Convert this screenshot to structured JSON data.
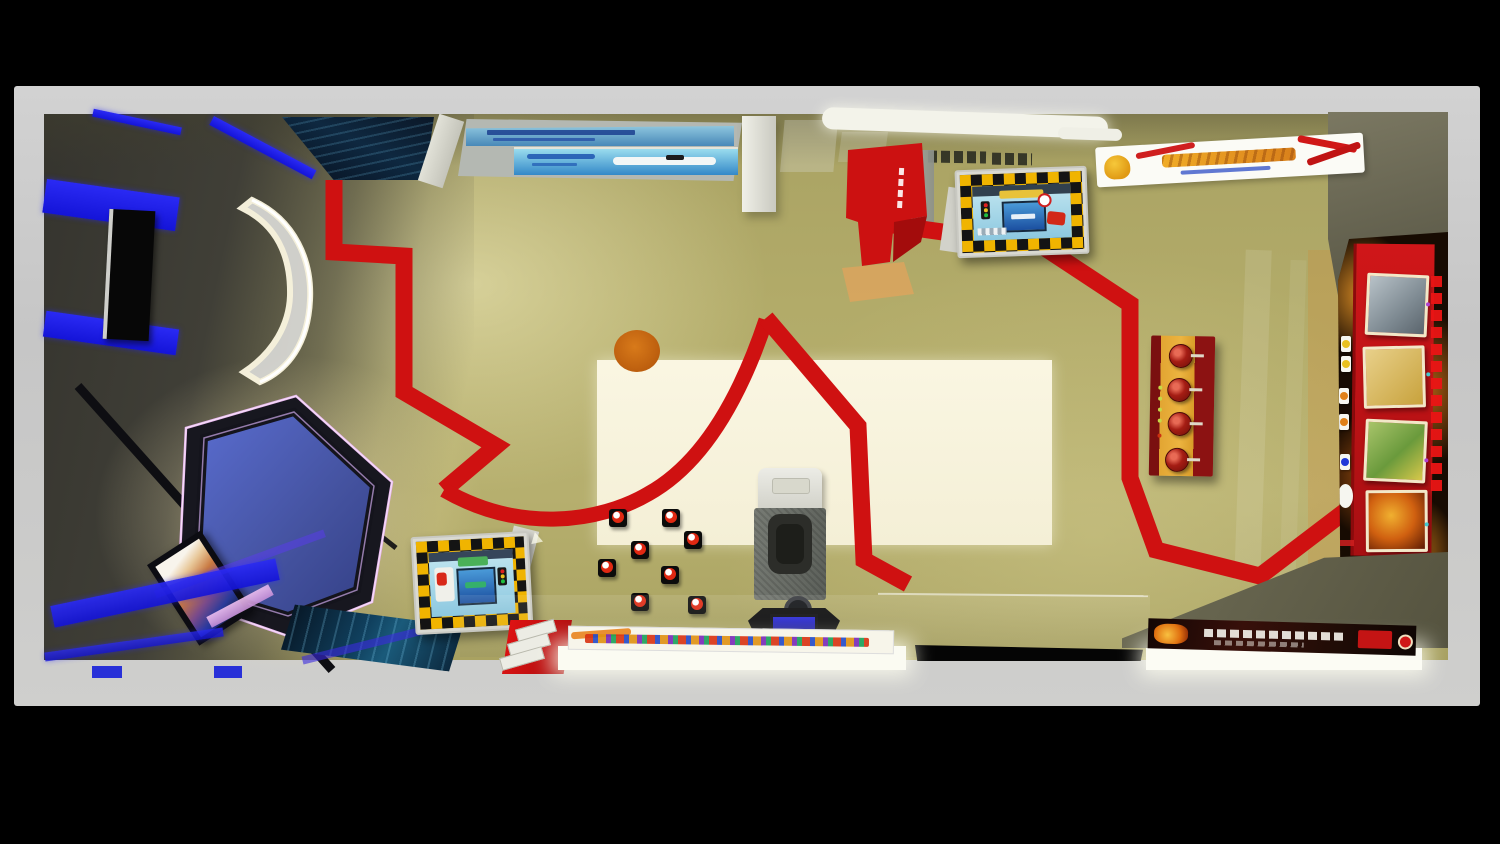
{
  "image": {
    "kind": "3D rendered top-down view",
    "subject": "Public safety education exhibition hall (traffic and fire safety experience room)",
    "background": "#000000",
    "legible_text": false
  },
  "palette": {
    "outer_frame": "#c9c9c9",
    "floor": "#b2ab69",
    "floor_inlay": "#f8f4de",
    "guide_path_red": "#cf1111",
    "led_blue": "#1f1ff0",
    "neon_pink": "#e9b7f0",
    "hexagon_blue": "#4c5fc4",
    "checker_yellow": "#f0b400",
    "flame_orange": "#d0761c",
    "panel_red": "#c01317",
    "console_gold": "#e0a32e",
    "screen_blue": "#3a7fb8",
    "lightbox_white": "#fbfbf2",
    "marker_orange": "#cc6d14"
  },
  "exhibits": {
    "entry_screen_wall": {
      "label": "wall-mounted blue info screens with ship image",
      "note": "captions illegible"
    },
    "starfield_panel": {
      "label": "dark starfield graphic wall panel"
    },
    "reception_desk": {
      "label": "white curved glowing reception desk"
    },
    "vr_hexagon": {
      "label": "hexagonal VR platform with pink neon edge and blue deck"
    },
    "truss_beams": {
      "label": "black diagonal truss beams"
    },
    "media_screen": {
      "label": "tilted media screen with colorful content"
    },
    "ocean_graphic": {
      "label": "dark ocean floor graphic"
    },
    "led_strips": {
      "label": "blue LED floor strips in dark west zone"
    },
    "traffic_game_table_north": {
      "label": "traffic-safety game table, yellow-black checker border"
    },
    "traffic_game_table_south": {
      "label": "traffic-safety game table, yellow-black checker border"
    },
    "red_guide_path": {
      "label": "red visitor guide path painted on floor"
    },
    "orange_floor_dot": {
      "label": "orange circular floor marker"
    },
    "stools": {
      "label": "eight square stools with red target cushions",
      "count": 8
    },
    "riding_simulator": {
      "label": "riding simulator with seat and floor screen"
    },
    "extinguisher_console": {
      "label": "gold console holding four red fire extinguishers"
    },
    "fire_wall": {
      "label": "flame-themed exhibition wall with photo cards and vertical red title",
      "note": "text illegible"
    },
    "north_banner": {
      "label": "white banner with mascot and orange calligraphy title",
      "note": "text illegible"
    },
    "red_totem": {
      "label": "red totem structure with vertical white lettering",
      "note": "text illegible"
    },
    "south_lightbox_west": {
      "label": "white lightbox counter with colorful slogan strip",
      "note": "text illegible"
    },
    "south_lightbox_east": {
      "label": "dark fire-themed banner over white lightbox",
      "note": "text illegible"
    },
    "brochure_box": {
      "label": "red box with stacked white brochures"
    },
    "entrance_gap": {
      "label": "dark entrance opening in south wall"
    }
  }
}
